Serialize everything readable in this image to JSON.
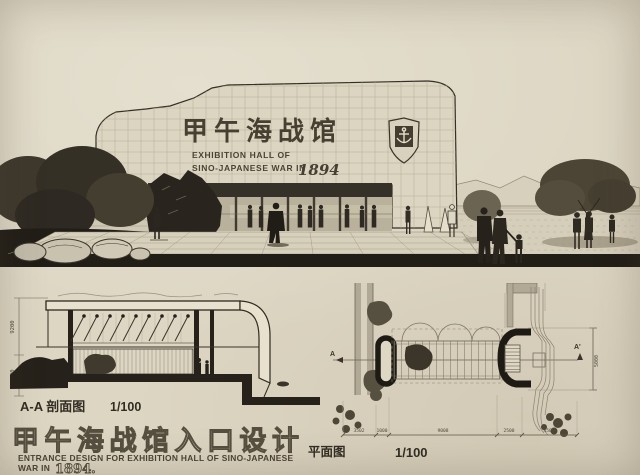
{
  "perspective": {
    "title_zh": "甲午海战馆",
    "subtitle_line1": "EXHIBITION HALL OF",
    "subtitle_line2": "SINO-JAPANESE WAR IN",
    "year": "1894"
  },
  "section": {
    "label_zh": "A-A 剖面图",
    "scale": "1/100",
    "dim_upper": "9200",
    "dim_lower": "2400"
  },
  "plan": {
    "label_zh": "平面图",
    "scale": "1/100",
    "marker_left": "A",
    "marker_right": "A'",
    "dim_right": "5000",
    "bottom_dims": [
      "3502",
      "1000",
      "9008",
      "2500",
      "4500"
    ]
  },
  "footer": {
    "title_zh": "甲午海战馆入口设计",
    "subtitle_line1": "ENTRANCE DESIGN FOR EXHIBITION HALL OF SINO-JAPANESE",
    "subtitle_line2": "WAR IN",
    "year": "1894."
  },
  "colors": {
    "paper": "#ddd6c3",
    "ink": "#352f26",
    "poche": "#26211a"
  }
}
